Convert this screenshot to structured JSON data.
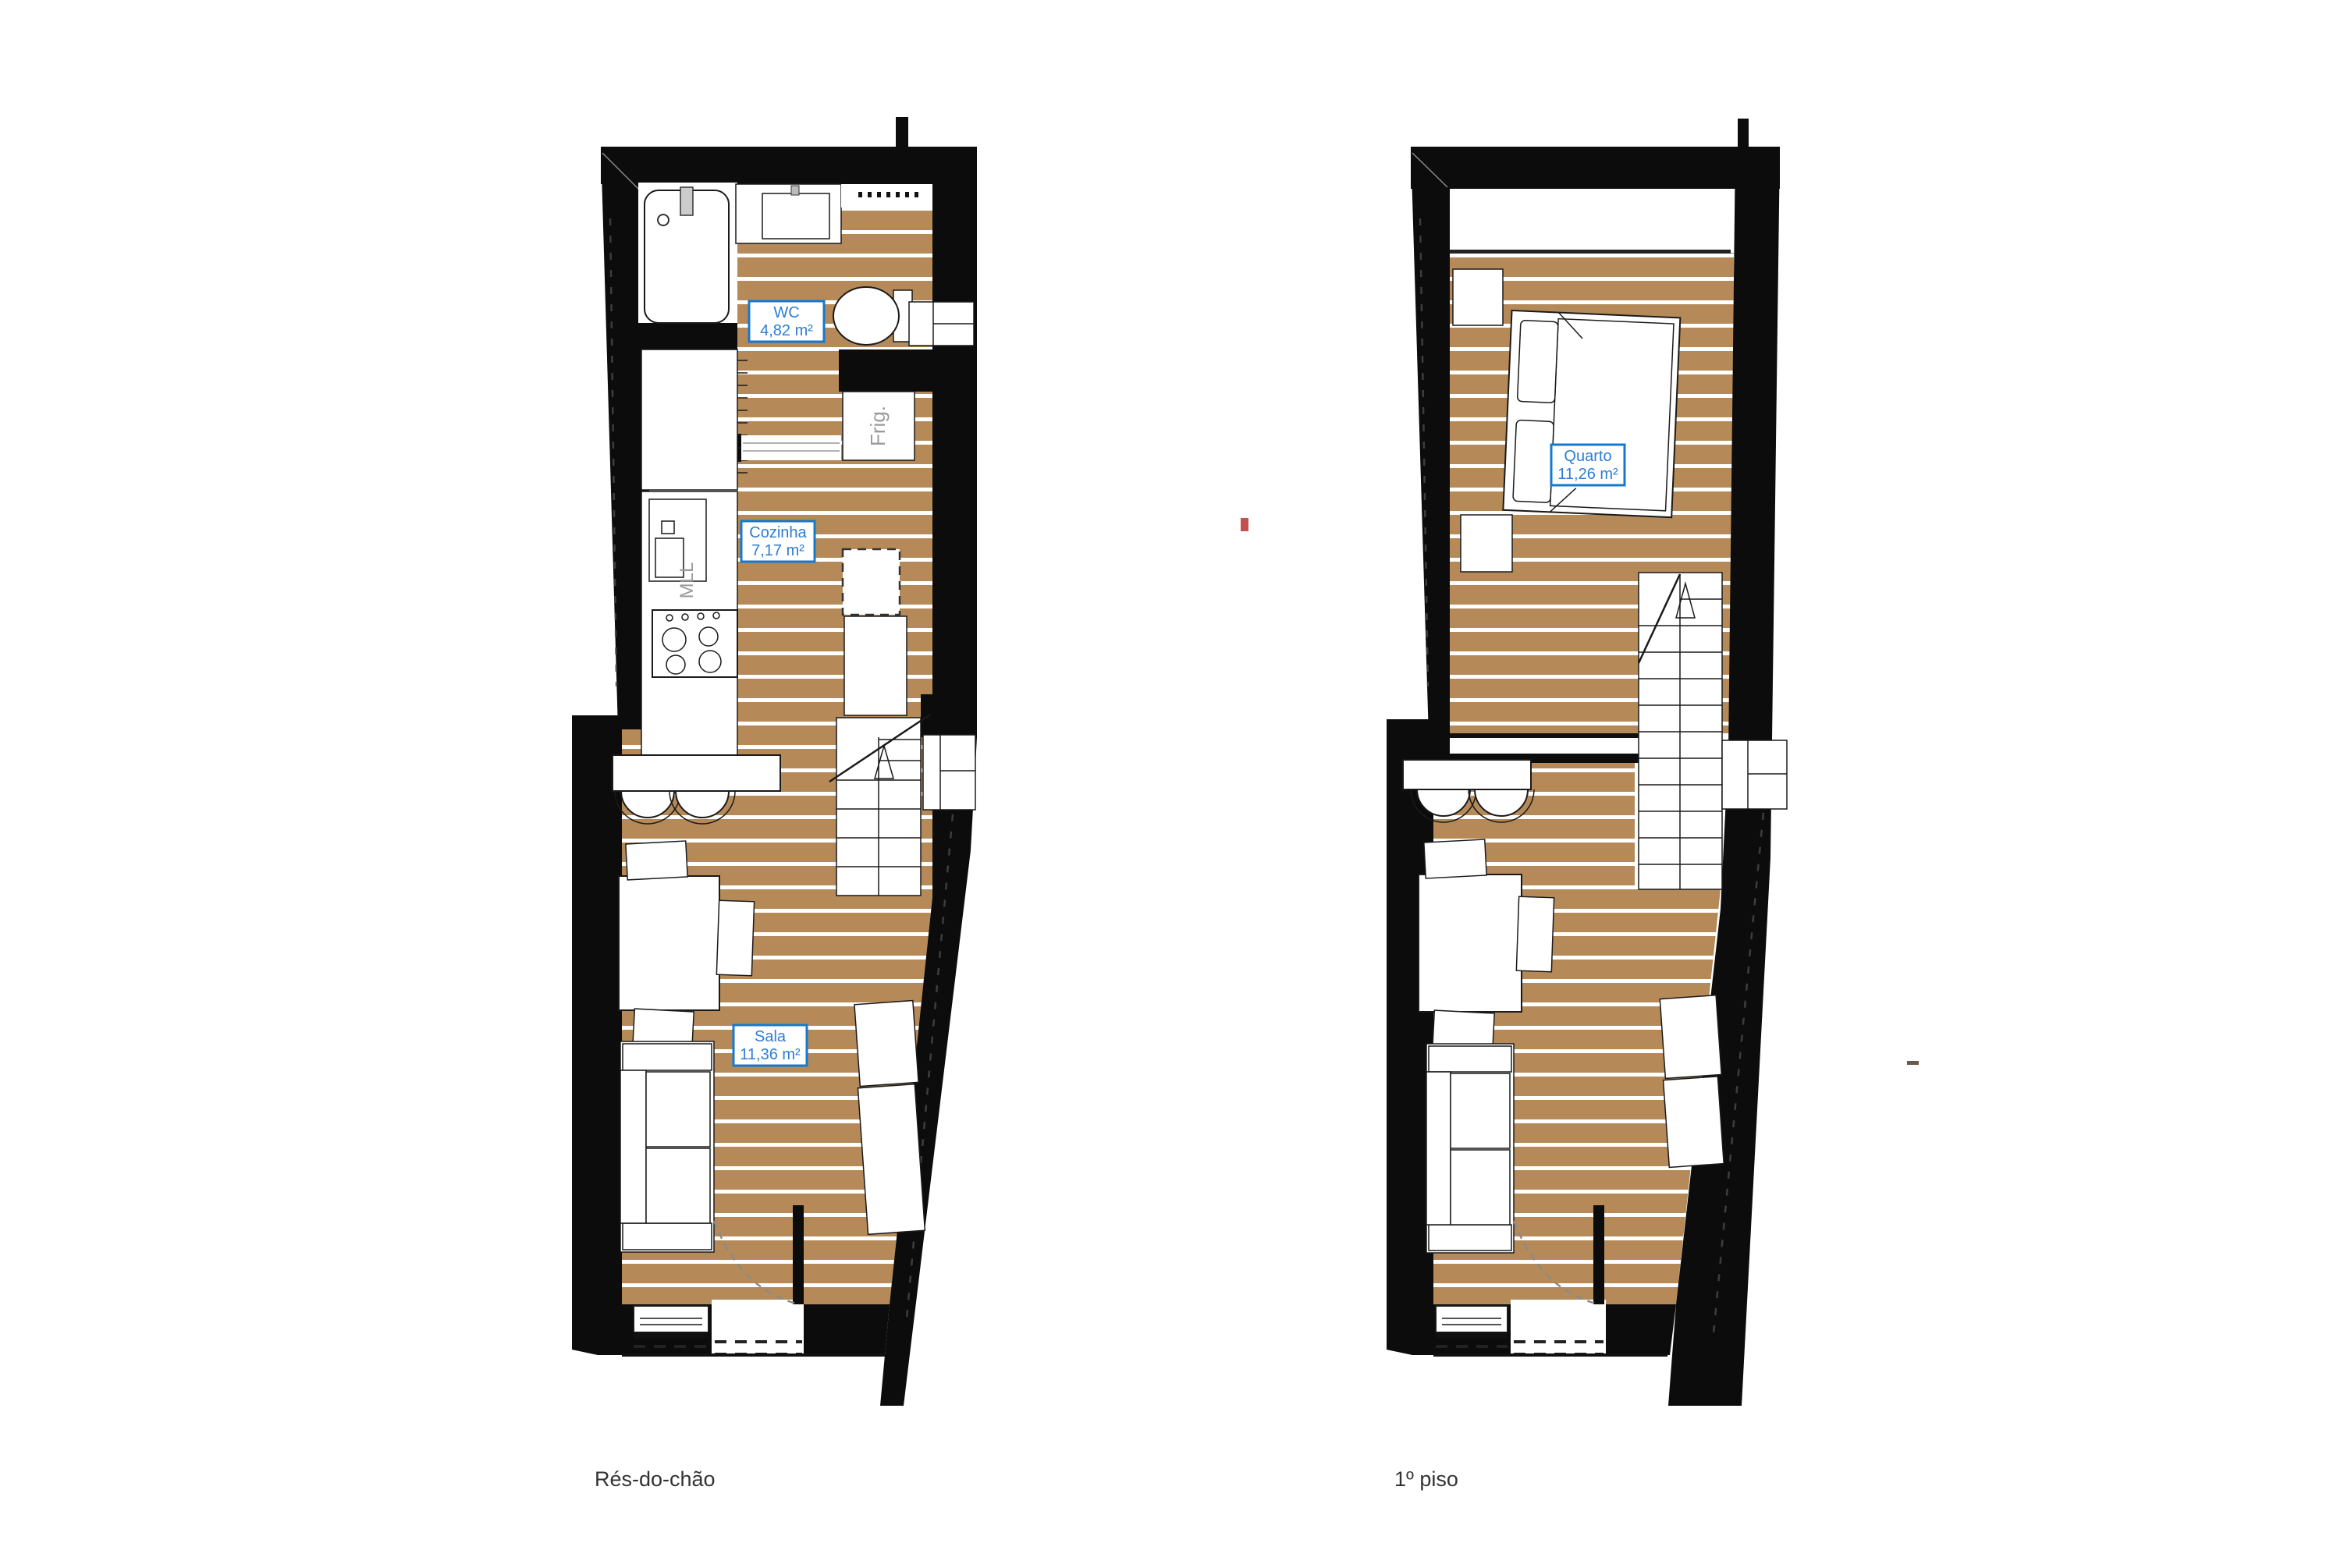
{
  "document_type": "architectural floor plan",
  "colors": {
    "wall": "#0c0c0c",
    "floor": "#b58a58",
    "plank_gap": "#ffffff",
    "label_border": "#1778d0",
    "label_text": "#2d7dd6",
    "appliance_text": "#9b9b9b",
    "caption_text": "#333333",
    "red_mark": "#c65050"
  },
  "plans": [
    {
      "caption": "Rés-do-chão",
      "rooms": [
        {
          "name": "WC",
          "area": "4,82 m²"
        },
        {
          "name": "Cozinha",
          "area": "7,17 m²"
        },
        {
          "name": "Sala",
          "area": "11,36 m²"
        }
      ],
      "appliances": {
        "fridge": "Frig.",
        "washing_machine": "MLL"
      }
    },
    {
      "caption": "1º piso",
      "rooms": [
        {
          "name": "Quarto",
          "area": "11,26 m²"
        }
      ]
    }
  ]
}
